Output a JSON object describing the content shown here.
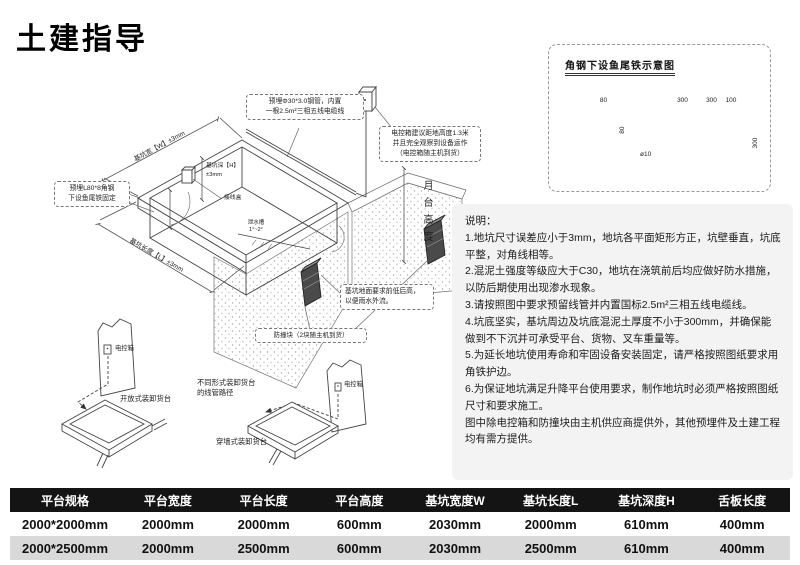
{
  "page": {
    "title": "土建指导"
  },
  "detail_panel": {
    "title": "角钢下设鱼尾铁示意图",
    "dims": {
      "angle_width": "80",
      "angle_height": "80",
      "pin_span_1": "300",
      "pin_span_2": "300",
      "pin_span_3": "100",
      "pin_depth": "300",
      "pin_diameter": "ø10"
    }
  },
  "main_drawing": {
    "callout_pipe_line1": "预埋Φ30*3.0钢管，内置",
    "callout_pipe_line2": "一根2.5m²三相五线电缆线",
    "callout_control_line1": "电控箱建议距地高度1.3米",
    "callout_control_line2": "并且完全观察到设备运作",
    "callout_control_line3": "（电控箱随主机到货）",
    "callout_angle_line1": "预埋L80*8角钢",
    "callout_angle_line2": "下设鱼尾铁固定",
    "callout_ground_line1": "基坑地面要求前低后高，",
    "callout_ground_line2": "以便雨水外流。",
    "label_bumper": "防撞块（2块随主机到货）",
    "dim_pit_width": "基坑宽【W】±3mm",
    "dim_pit_length": "基坑长度【L】±3mm",
    "dim_pit_depth_line1": "基坑深【H】",
    "dim_pit_depth_line2": "±3mm",
    "dim_dock_height": "月台高度",
    "label_junction_box": "接线盒",
    "label_drain_line1": "泄水槽",
    "label_drain_line2": "1°~2°",
    "label_control_box_a": "电控箱",
    "label_control_box_b": "电控箱",
    "label_dock_open": "开放式装卸货台",
    "label_dock_through": "穿墙式装卸货台",
    "label_conduit_note_line1": "不同形式装卸货台",
    "label_conduit_note_line2": "的线管路径"
  },
  "notes": {
    "title": "说明：",
    "items": [
      "1.地坑尺寸误差应小于3mm，地坑各平面矩形方正，坑壁垂直，坑底平整，对角线相等。",
      "2.混泥土强度等级应大于C30，地坑在浇筑前后均应做好防水措施，以防后期使用出现渗水现象。",
      "3.请按照图中要求预留线管并内置国标2.5m²三相五线电缆线。",
      "4.坑底坚实，基坑周边及坑底混泥土厚度不小于300mm，并确保能做到不下沉并可承受平台、货物、叉车重量等。",
      "5.为延长地坑使用寿命和牢固设备安装固定，请严格按照图纸要求用角铁护边。",
      "6.为保证地坑满足升降平台使用要求，制作地坑时必须严格按照图纸尺寸和要求施工。",
      "图中除电控箱和防撞块由主机供应商提供外，其他预埋件及土建工程均有需方提供。"
    ]
  },
  "table": {
    "headers": [
      "平台规格",
      "平台宽度",
      "平台长度",
      "平台高度",
      "基坑宽度W",
      "基坑长度L",
      "基坑深度H",
      "舌板长度"
    ],
    "rows": [
      [
        "2000*2000mm",
        "2000mm",
        "2000mm",
        "600mm",
        "2030mm",
        "2000mm",
        "610mm",
        "400mm"
      ],
      [
        "2000*2500mm",
        "2000mm",
        "2500mm",
        "600mm",
        "2030mm",
        "2500mm",
        "610mm",
        "400mm"
      ]
    ]
  },
  "colors": {
    "table_header_bg": "#141414",
    "table_row_alt_bg": "#d9d9d9",
    "notes_bg": "#f3f3f3",
    "accent_text": "#111111"
  }
}
